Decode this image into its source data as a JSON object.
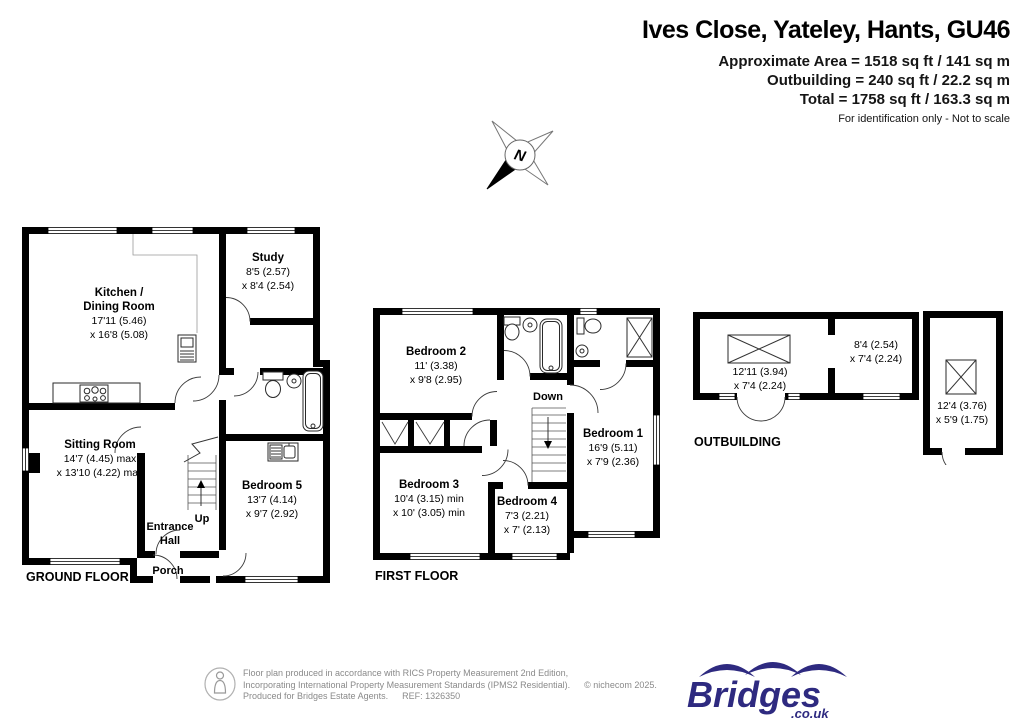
{
  "header": {
    "title": "Ives Close, Yateley, Hants, GU46",
    "lines": [
      "Approximate Area = 1518 sq ft / 141 sq m",
      "Outbuilding = 240 sq ft / 22.2 sq m",
      "Total = 1758 sq ft / 163.3 sq m"
    ],
    "disclaimer": "For identification only - Not to scale"
  },
  "compass": {
    "north": "N"
  },
  "floors": {
    "ground": {
      "label": "GROUND FLOOR",
      "rooms": {
        "kitchen": {
          "name1": "Kitchen /",
          "name2": "Dining Room",
          "dim1": "17'11 (5.46)",
          "dim2": "x 16'8 (5.08)"
        },
        "study": {
          "name": "Study",
          "dim1": "8'5 (2.57)",
          "dim2": "x 8'4 (2.54)"
        },
        "sitting": {
          "name": "Sitting Room",
          "dim1": "14'7 (4.45) max",
          "dim2": "x 13'10 (4.22) max"
        },
        "bedroom5": {
          "name": "Bedroom 5",
          "dim1": "13'7 (4.14)",
          "dim2": "x 9'7 (2.92)"
        },
        "entrance1": "Entrance",
        "entrance2": "Hall",
        "porch": "Porch",
        "up": "Up"
      }
    },
    "first": {
      "label": "FIRST FLOOR",
      "rooms": {
        "bedroom1": {
          "name": "Bedroom 1",
          "dim1": "16'9 (5.11)",
          "dim2": "x 7'9 (2.36)"
        },
        "bedroom2": {
          "name": "Bedroom 2",
          "dim1": "11' (3.38)",
          "dim2": "x 9'8 (2.95)"
        },
        "bedroom3": {
          "name": "Bedroom 3",
          "dim1": "10'4 (3.15) min",
          "dim2": "x 10' (3.05) min"
        },
        "bedroom4": {
          "name": "Bedroom 4",
          "dim1": "7'3 (2.21)",
          "dim2": "x 7' (2.13)"
        },
        "down": "Down"
      }
    },
    "outbuilding": {
      "label": "OUTBUILDING",
      "rooms": {
        "left": {
          "dim1": "12'11 (3.94)",
          "dim2": "x 7'4 (2.24)"
        },
        "mid": {
          "dim1": "8'4 (2.54)",
          "dim2": "x 7'4 (2.24)"
        },
        "right": {
          "dim1": "12'4 (3.76)",
          "dim2": "x 5'9 (1.75)"
        }
      }
    }
  },
  "footer": {
    "line1": "Floor plan produced in accordance with RICS Property Measurement 2nd Edition,",
    "line2": "Incorporating International Property Measurement Standards (IPMS2 Residential).",
    "copyright": "© nichecom 2025.",
    "line3": "Produced for Bridges Estate Agents.",
    "ref": "REF: 1326350",
    "logo_text": "Bridges",
    "logo_sub": ".co.uk"
  },
  "colors": {
    "wall": "#000000",
    "brand_navy": "#2e2a80",
    "footer_gray": "#8a8a8a"
  }
}
